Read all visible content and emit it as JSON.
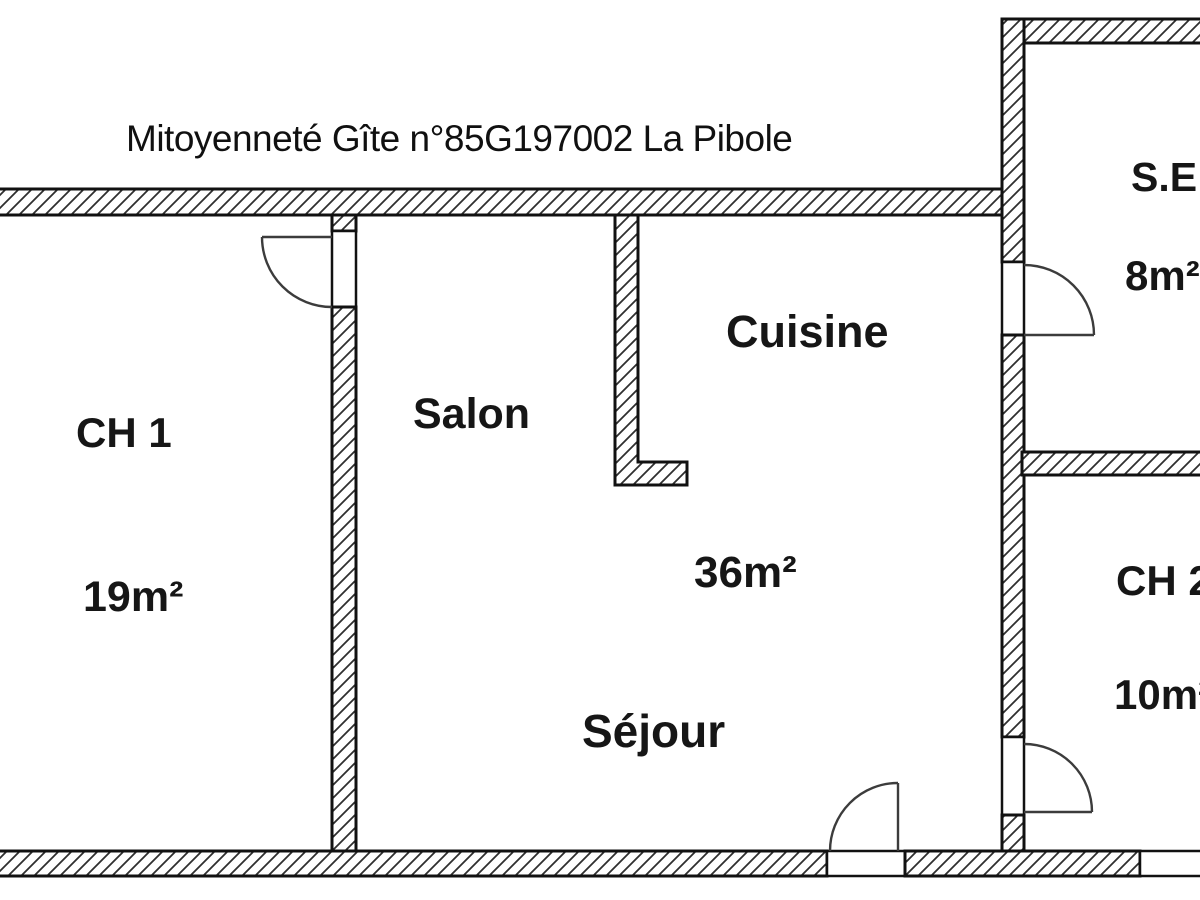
{
  "title": "Mitoyenneté Gîte n°85G197002 La Pibole",
  "rooms": {
    "ch1": {
      "label": "CH 1",
      "area": "19m²"
    },
    "salon": {
      "label": "Salon"
    },
    "cuisine": {
      "label": "Cuisine"
    },
    "sejour": {
      "label": "Séjour",
      "area": "36m²"
    },
    "se": {
      "label": "S.E",
      "area": "8m²"
    },
    "ch2": {
      "label": "CH 2",
      "area": "10m²"
    }
  },
  "colors": {
    "background": "#ffffff",
    "wall_outline": "#111111",
    "hatch_line": "#2f2f2f",
    "text": "#161616"
  }
}
